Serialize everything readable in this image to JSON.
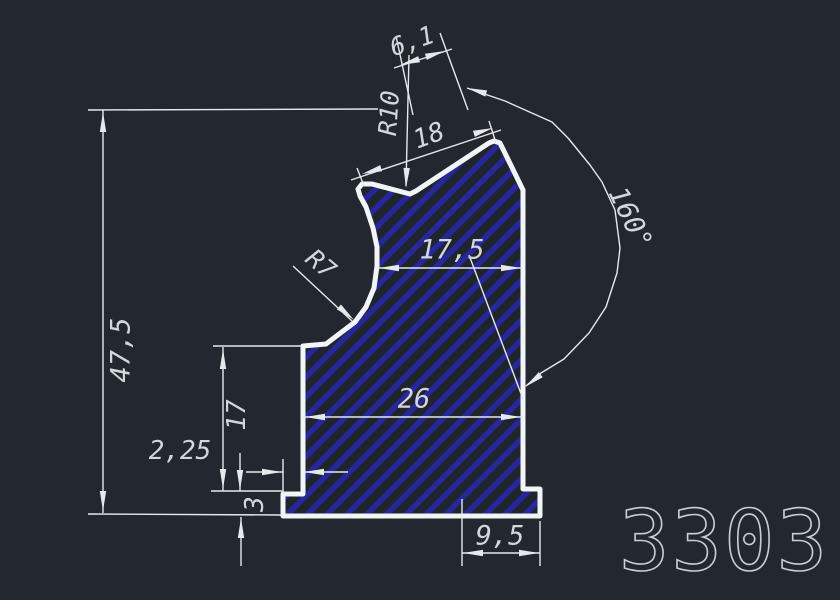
{
  "drawing_title": "Profile section 3303",
  "part_number": {
    "text": "3303",
    "x": 724,
    "y": 541,
    "size": 84,
    "color": "#c9ced3"
  },
  "canvas": {
    "width": 840,
    "height": 600,
    "background": "#232830"
  },
  "colors": {
    "outline": "#f2f4f6",
    "thin": "#e6e9eb",
    "hatch": "#26269e",
    "profile_fill": "#20252c",
    "text": "#d3d7da"
  },
  "profile": {
    "stroke_width": 5,
    "points": [
      [
        362,
        184
      ],
      [
        372,
        184
      ],
      [
        410,
        194
      ],
      [
        416,
        191
      ],
      [
        489,
        143
      ],
      [
        494,
        141
      ],
      [
        500,
        143
      ],
      [
        523,
        190
      ],
      [
        523,
        489
      ],
      [
        540,
        489
      ],
      [
        540,
        516
      ],
      [
        283,
        516
      ],
      [
        283,
        494
      ],
      [
        303,
        494
      ],
      [
        303,
        346
      ],
      [
        326,
        344
      ],
      [
        355,
        322
      ],
      [
        366,
        307
      ],
      [
        374,
        288
      ],
      [
        377,
        266
      ],
      [
        377,
        247
      ],
      [
        373,
        228
      ],
      [
        366,
        207
      ],
      [
        360,
        196
      ],
      [
        358,
        189
      ]
    ]
  },
  "hatch": {
    "spacing": 14,
    "line_width": 5.5,
    "angle": -45
  },
  "thin_lines": [
    {
      "name": "ext-47-5-top",
      "pts": [
        88,
        110,
        378,
        109
      ]
    },
    {
      "name": "dim-line-47-5",
      "pts": [
        103,
        110,
        103,
        513
      ]
    },
    {
      "name": "ext-47-5-bottom",
      "pts": [
        88,
        514,
        281,
        515
      ]
    },
    {
      "name": "ext-17-top",
      "pts": [
        213,
        346,
        301,
        346
      ]
    },
    {
      "name": "ext-17-bottom",
      "pts": [
        211,
        491,
        283,
        491
      ]
    },
    {
      "name": "dim-line-17",
      "pts": [
        223,
        347,
        223,
        491
      ]
    },
    {
      "name": "dim-line-2-25-left",
      "pts": [
        246,
        472,
        283,
        472
      ]
    },
    {
      "name": "dim-line-2-25-right",
      "pts": [
        303,
        472,
        348,
        472
      ]
    },
    {
      "name": "ext-2-25",
      "pts": [
        283,
        459,
        283,
        494
      ]
    },
    {
      "name": "dim-line-3-upper",
      "pts": [
        240,
        453,
        240,
        491
      ]
    },
    {
      "name": "dim-line-3-lower",
      "pts": [
        241,
        517,
        241,
        566
      ]
    },
    {
      "name": "ext-9-5-left",
      "pts": [
        462,
        499,
        462,
        566
      ]
    },
    {
      "name": "ext-9-5-right",
      "pts": [
        540,
        521,
        540,
        566
      ]
    },
    {
      "name": "dim-line-9-5",
      "pts": [
        462,
        553,
        540,
        553
      ]
    },
    {
      "name": "dim-line-17-5",
      "pts": [
        377,
        268,
        523,
        268
      ]
    },
    {
      "name": "dim-line-26",
      "pts": [
        303,
        417,
        523,
        417
      ]
    },
    {
      "name": "dim-line-18",
      "pts": [
        351,
        180,
        501,
        130
      ]
    },
    {
      "name": "ext-18-left",
      "pts": [
        364,
        186,
        357,
        168
      ]
    },
    {
      "name": "ext-18-right",
      "pts": [
        496,
        143,
        489,
        121
      ]
    },
    {
      "name": "dim-line-6-1",
      "pts": [
        394,
        68,
        452,
        49
      ]
    },
    {
      "name": "ext-6-1-left",
      "pts": [
        396,
        36,
        413,
        115
      ]
    },
    {
      "name": "ext-6-1-right",
      "pts": [
        440,
        33,
        468,
        110
      ]
    },
    {
      "name": "leader-r10",
      "pts": [
        409,
        55,
        406,
        186
      ]
    },
    {
      "name": "leader-r7",
      "pts": [
        293,
        266,
        352,
        321
      ]
    },
    {
      "name": "angle-extension",
      "pts": [
        469,
        255,
        523,
        399
      ]
    }
  ],
  "arc": {
    "name": "angle-arc-160",
    "points": [
      [
        467,
        88
      ],
      [
        505,
        101
      ],
      [
        552,
        122
      ],
      [
        568,
        138
      ],
      [
        590,
        165
      ],
      [
        602,
        182
      ],
      [
        615,
        210
      ],
      [
        620,
        248
      ],
      [
        617,
        273
      ],
      [
        606,
        307
      ],
      [
        589,
        333
      ],
      [
        564,
        359
      ],
      [
        541,
        373
      ],
      [
        526,
        386
      ]
    ]
  },
  "arrows": [
    {
      "x": 103,
      "y": 112,
      "a": -90
    },
    {
      "x": 103,
      "y": 511,
      "a": 90
    },
    {
      "x": 223,
      "y": 349,
      "a": -90
    },
    {
      "x": 223,
      "y": 489,
      "a": 90
    },
    {
      "x": 282,
      "y": 472,
      "a": 0
    },
    {
      "x": 304,
      "y": 472,
      "a": 180
    },
    {
      "x": 240,
      "y": 490,
      "a": 90
    },
    {
      "x": 241,
      "y": 518,
      "a": -90
    },
    {
      "x": 463,
      "y": 553,
      "a": 180
    },
    {
      "x": 539,
      "y": 553,
      "a": 0
    },
    {
      "x": 379,
      "y": 268,
      "a": 180
    },
    {
      "x": 521,
      "y": 268,
      "a": 0
    },
    {
      "x": 305,
      "y": 417,
      "a": 180
    },
    {
      "x": 521,
      "y": 417,
      "a": 0
    },
    {
      "x": 362,
      "y": 174,
      "a": 163
    },
    {
      "x": 493,
      "y": 128,
      "a": -17
    },
    {
      "x": 400,
      "y": 65,
      "a": 163
    },
    {
      "x": 445,
      "y": 51,
      "a": -17
    },
    {
      "x": 406,
      "y": 188,
      "a": 92
    },
    {
      "x": 354,
      "y": 320,
      "a": 41
    },
    {
      "x": 467,
      "y": 88,
      "a": 196
    },
    {
      "x": 525,
      "y": 387,
      "a": 142
    }
  ],
  "labels": [
    {
      "name": "dim-label-6-1",
      "text": "6,1",
      "x": 412,
      "y": 41,
      "rot": -19,
      "size": 25
    },
    {
      "name": "dim-label-r10",
      "text": "R10",
      "x": 389,
      "y": 113,
      "rot": -86,
      "size": 25
    },
    {
      "name": "dim-label-18",
      "text": "18",
      "x": 429,
      "y": 136,
      "rot": -20,
      "size": 26
    },
    {
      "name": "dim-label-160deg",
      "text": "160°",
      "x": 630,
      "y": 218,
      "rot": 64,
      "size": 27
    },
    {
      "name": "dim-label-17-5",
      "text": "17,5",
      "x": 452,
      "y": 250,
      "rot": 0,
      "size": 27
    },
    {
      "name": "dim-label-r7",
      "text": "R7",
      "x": 321,
      "y": 264,
      "rot": 40,
      "size": 25
    },
    {
      "name": "dim-label-47-5",
      "text": "47,5",
      "x": 121,
      "y": 350,
      "rot": -90,
      "size": 27
    },
    {
      "name": "dim-label-26",
      "text": "26",
      "x": 414,
      "y": 399,
      "rot": 0,
      "size": 27
    },
    {
      "name": "dim-label-17",
      "text": "17",
      "x": 237,
      "y": 415,
      "rot": -90,
      "size": 26
    },
    {
      "name": "dim-label-2-25",
      "text": "2,25",
      "x": 180,
      "y": 451,
      "rot": 0,
      "size": 26
    },
    {
      "name": "dim-label-3",
      "text": "3",
      "x": 255,
      "y": 504,
      "rot": -90,
      "size": 26
    },
    {
      "name": "dim-label-9-5",
      "text": "9,5",
      "x": 500,
      "y": 536,
      "rot": 0,
      "size": 27
    }
  ]
}
